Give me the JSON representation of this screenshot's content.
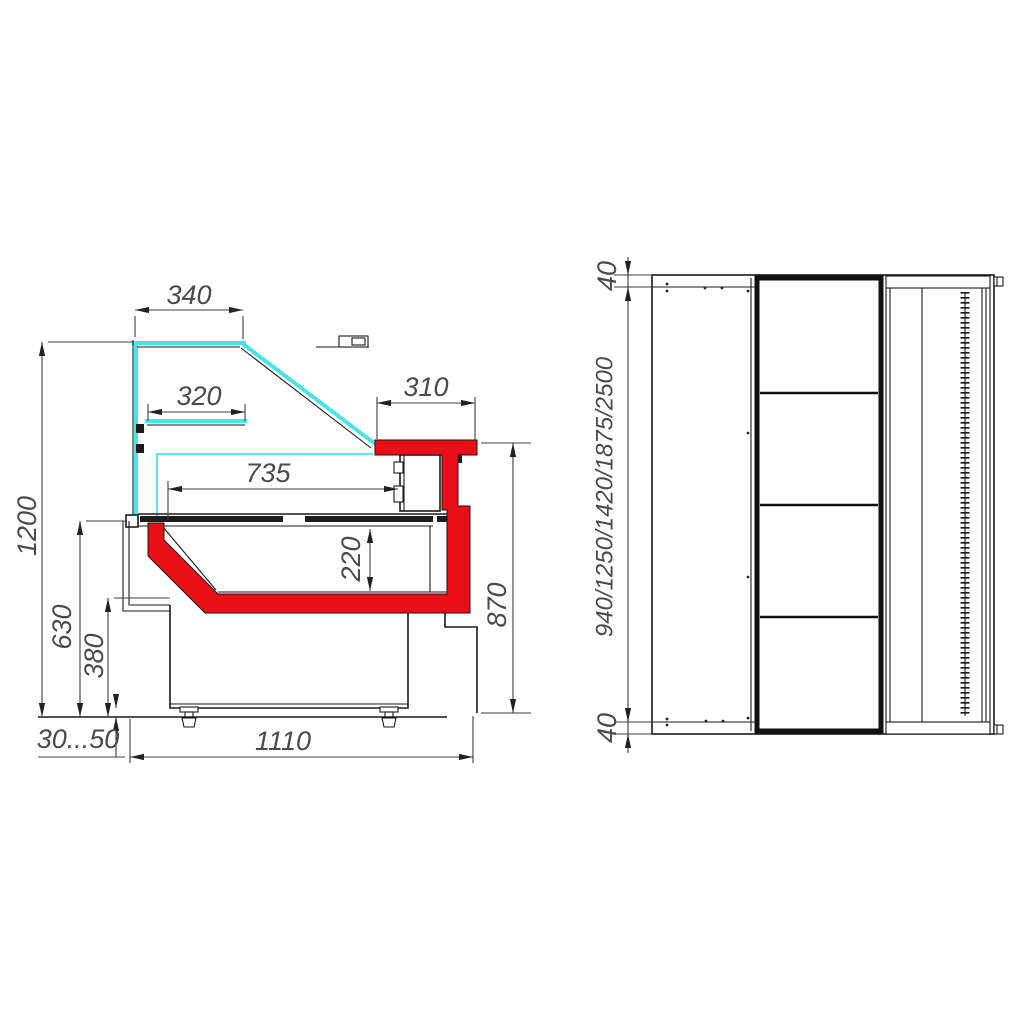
{
  "colors": {
    "glass": "#48e4e8",
    "accent": "#ea0f17",
    "line": "#1a1a1a",
    "dim_text": "#4a4a4a"
  },
  "side_view": {
    "dims": {
      "d340": "340",
      "d320": "320",
      "d310": "310",
      "d735": "735",
      "d220": "220",
      "d1200": "1200",
      "d630": "630",
      "d380": "380",
      "d870": "870",
      "d30_50": "30...50",
      "d1110": "1110"
    }
  },
  "plan_view": {
    "dims": {
      "d40_top": "40",
      "d40_bottom": "40",
      "lengths": "940/1250/1420/1875/2500"
    }
  }
}
